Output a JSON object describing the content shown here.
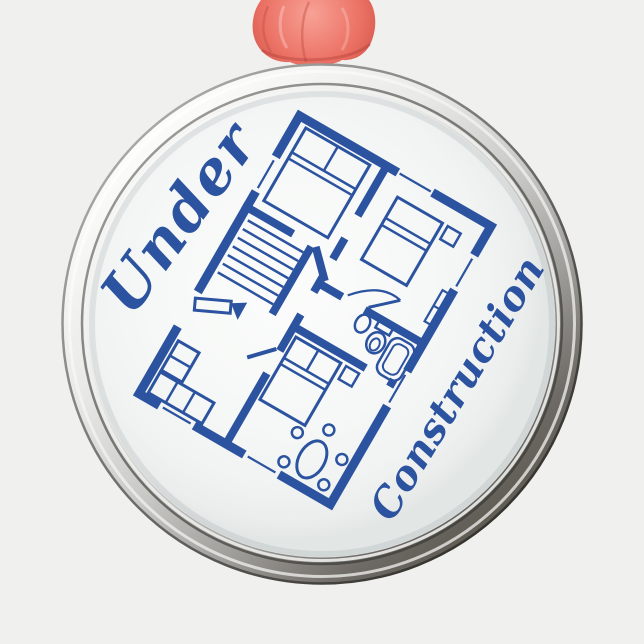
{
  "scene": {
    "description": "photo of a round silver metal ornament with coral ribbon knot",
    "background_color": "#f0f0ee"
  },
  "ornament": {
    "text_top": "Under",
    "text_bottom": "Construction",
    "design_name": "house-floor-plan-blueprint",
    "colors": {
      "blueprint_blue": "#2c53a0",
      "face_white": "#f7f8f7",
      "rim_silver": "#c9c9c6",
      "ribbon_coral": "#ee7266",
      "background": "#f0f0ee"
    }
  }
}
